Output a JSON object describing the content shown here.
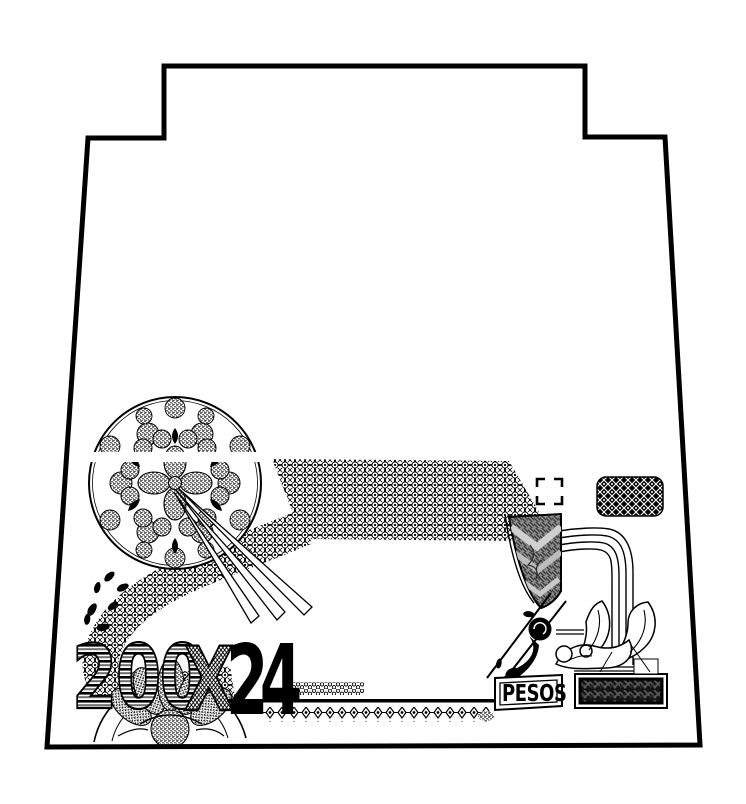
{
  "artwork": {
    "texts": {
      "denomination": "200",
      "multiplier": "X",
      "counter": "24",
      "currency": "PESOS"
    },
    "colors": {
      "ink": "#000000",
      "paper": "#ffffff",
      "panel_gray": "#8e8e8e",
      "chevron_light": "#d0d0d0",
      "stripe_gray": "#6e6e6e",
      "pedestal_dark": "#141414"
    }
  }
}
